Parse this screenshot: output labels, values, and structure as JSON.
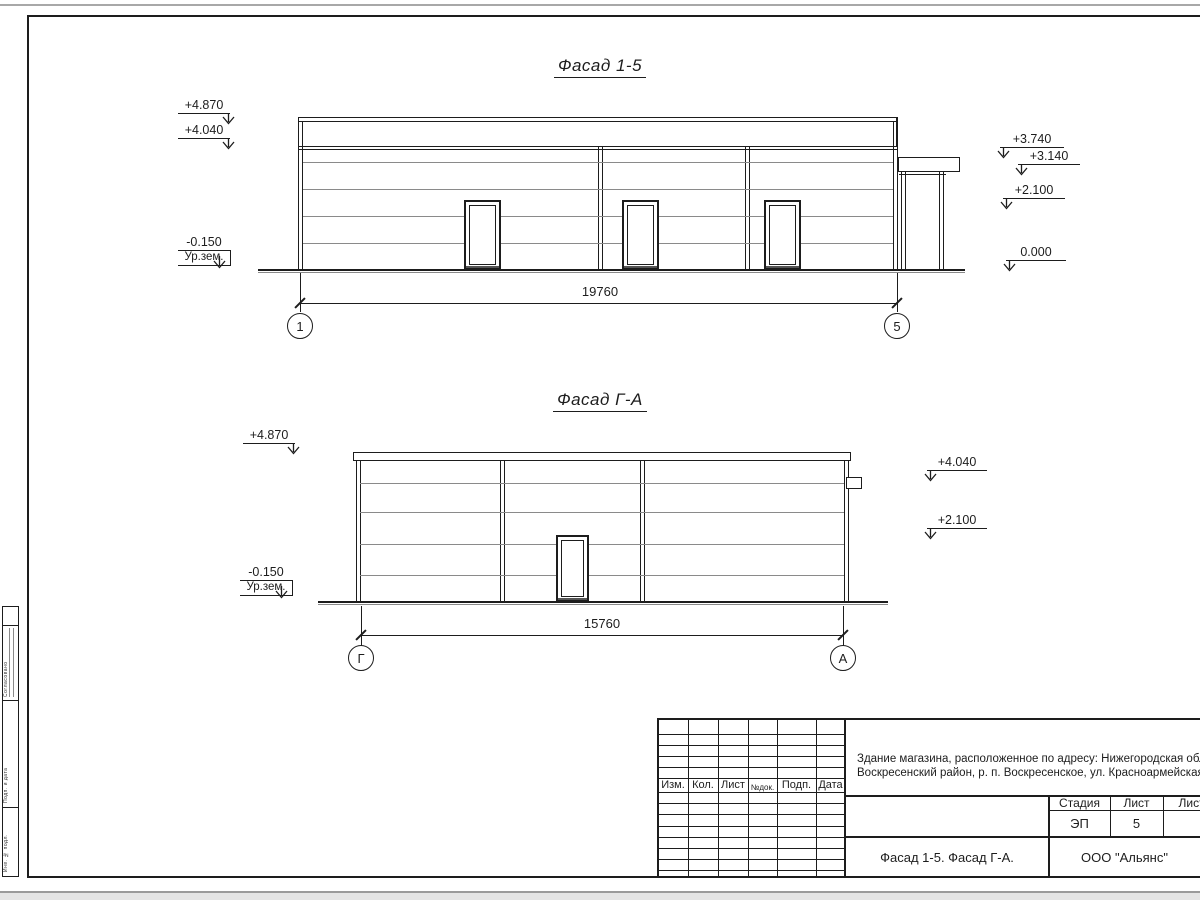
{
  "facade_top": {
    "title": "Фасад 1-5",
    "dimension_mm": "19760",
    "axes": [
      "1",
      "5"
    ],
    "elevations_left": [
      {
        "value": "+4.870"
      },
      {
        "value": "+4.040"
      },
      {
        "value": "-0.150",
        "note": "Ур.зем."
      }
    ],
    "elevations_right": [
      {
        "value": "+3.740"
      },
      {
        "value": "+3.140"
      },
      {
        "value": "+2.100"
      },
      {
        "value": "0.000"
      }
    ]
  },
  "facade_side": {
    "title": "Фасад Г-А",
    "dimension_mm": "15760",
    "axes": [
      "Г",
      "А"
    ],
    "elevations_left": [
      {
        "value": "+4.870"
      },
      {
        "value": "-0.150",
        "note": "Ур.зем."
      }
    ],
    "elevations_right": [
      {
        "value": "+4.040"
      },
      {
        "value": "+2.100"
      }
    ]
  },
  "title_block": {
    "revision_headers": [
      "Изм.",
      "Кол.",
      "Лист",
      "№док.",
      "Подп.",
      "Дата"
    ],
    "project_description_line1": "Здание магазина, расположенное по адресу: Нижегородская область,",
    "project_description_line2": "Воскресенский район, р. п. Воскресенское, ул. Красноармейская, д. 1",
    "stage": {
      "label": "Стадия",
      "value": "ЭП"
    },
    "sheet": {
      "label": "Лист",
      "value": "5"
    },
    "sheets_total": {
      "label": "Листов",
      "value": ""
    },
    "drawing_name": "Фасад 1-5. Фасад Г-А.",
    "organization": "ООО \"Альянс\""
  },
  "side_stamp": {
    "labels": [
      "Согласовано",
      "Подп. и дата",
      "Инв. № подл."
    ]
  }
}
